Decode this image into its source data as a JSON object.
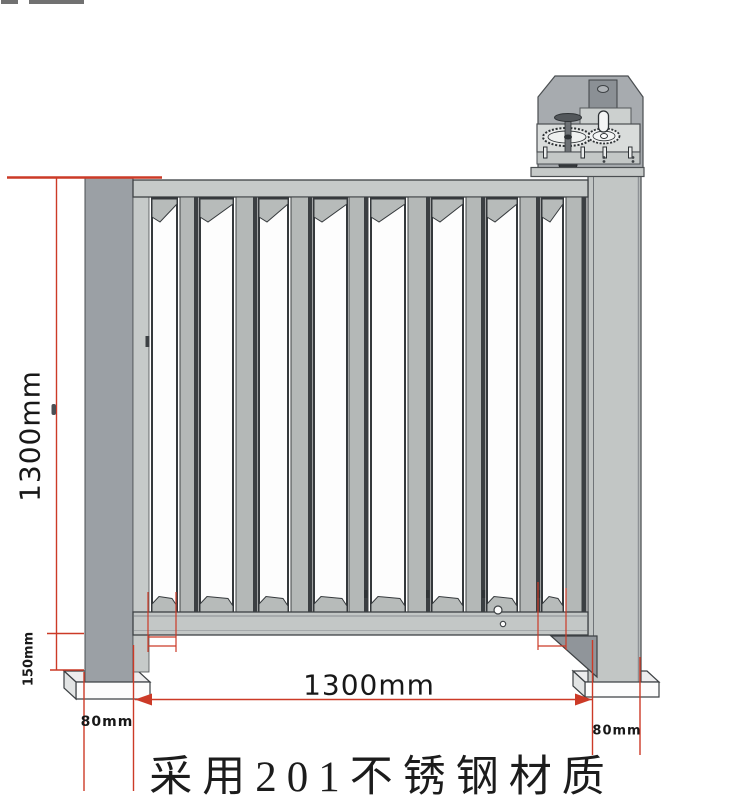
{
  "drawing": {
    "caption": "采用201不锈钢材质",
    "dim_height_label": "1300mm",
    "dim_width_label": "1300mm",
    "dim_rail_clearance_label": "150mm",
    "dim_left_post_label": "80mm",
    "dim_right_post_label": "80mm"
  },
  "components": {
    "left_post": "square steel post",
    "right_post": "drive-side steel post",
    "gate": "vertical-bar gate leaf",
    "mechanism": "gear drive unit with hand crank",
    "base_plates": "anchor base plates"
  },
  "colors": {
    "dimension_red": "#cc3a27",
    "steel_light": "#c6cac9",
    "steel_mid": "#b4b8b7",
    "steel_dark": "#9ba0a5",
    "outline": "#3d4144",
    "text": "#181818"
  }
}
